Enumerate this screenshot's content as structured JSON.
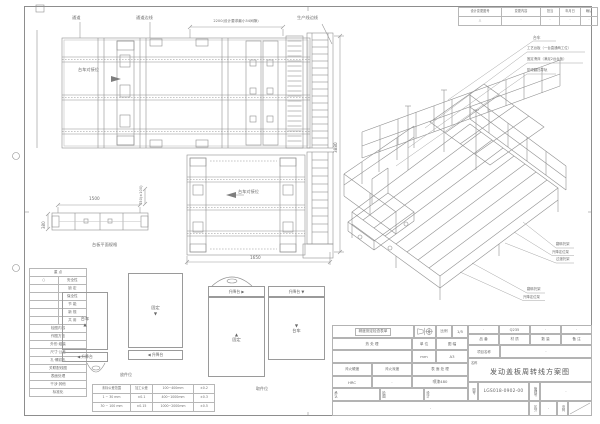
{
  "revision": {
    "headers": [
      "设计变更图号",
      "变更内容",
      "担当",
      "年月日",
      "确认"
    ],
    "values": [
      "△",
      "·",
      "·",
      "·",
      "·"
    ]
  },
  "plan": {
    "passage": "通道",
    "passage_edge": "通道边线",
    "prod_edge": "生产线边线",
    "dim_2200": "2200(设计要求最小54间隙)",
    "dim_3880": "3880",
    "dim_1650": "1650",
    "dock1": "台车对接位",
    "dock2": "台车对接位",
    "arrow_right": "▶",
    "arrow_left": "◀",
    "side": {
      "dim_1500": "1500",
      "dim_380": "380",
      "dim_750": "750(±100)",
      "caption": "台板平面规格"
    }
  },
  "iso": {
    "callouts_top": [
      "台车",
      "工艺台板（一台直通两工位）",
      "固定滑床（满足2台台板）",
      "防倾翻挡导轨"
    ],
    "callouts_right": [
      "翻转托架",
      "升降定位架",
      "过渡托架"
    ],
    "callouts_lower": [
      "翻转托架",
      "升降定位架"
    ]
  },
  "legend": {
    "title": "重 点",
    "items": [
      {
        "mark": "○",
        "label": "安全性"
      },
      {
        "mark": "",
        "label": "锁 定"
      },
      {
        "mark": "",
        "label": "保全性"
      },
      {
        "mark": "",
        "label": "节 能"
      },
      {
        "mark": "",
        "label": "新 规"
      },
      {
        "mark": "",
        "label": "共 用"
      }
    ],
    "subtitle": "检图内容",
    "checks": [
      "作图方法",
      "外形·组装",
      "尺寸·公差",
      "孔·螺纹孔",
      "关联配线图",
      "表面处理",
      "干涉·其他",
      "标准化"
    ]
  },
  "tolerance": {
    "rows": [
      [
        "未标公差范围",
        "加工公差",
        "100~400mm",
        "±0.2"
      ],
      [
        "1 ~ 30 mm",
        "±0.1",
        "400~1000mm",
        "±0.3"
      ],
      [
        "30 ~ 100 mm",
        "±0.15",
        "1000~2000mm",
        "±0.5"
      ]
    ]
  },
  "stations": {
    "g1_box": "台车",
    "g1_arrow": "▲",
    "g1_lift": "◀ 升降台",
    "g2_box": "固定",
    "g2_arrow": "▼",
    "g2_lift": "◀ 升降台",
    "g3_lift_left": "升降台 ▶",
    "g3_arrow_left": "▲",
    "g3_box_left": "固定",
    "g3_lift_right": "升降台 ▼",
    "g3_arrow_right": "▼",
    "g3_box_right": "台车",
    "label_put": "放件位",
    "label_take": "取件位"
  },
  "title_block": {
    "note": "精度测定检查表单",
    "scale_label": "比例",
    "scale_value": "1/5",
    "heat_label": "热 处 理",
    "heat_value": "",
    "unit_label": "单 位",
    "unit_value": "mm",
    "format_label": "图 幅",
    "format_value": "A3",
    "hardness_label": "淬火硬度",
    "hardness_value": "HRC",
    "depth_label": "淬火深度",
    "depth_value": "·",
    "surface_label": "表 面 处 理",
    "surface_value": "喷漆480",
    "approve_label": "承认",
    "check_label": "检图",
    "design_label": "设计",
    "footer_value": "·",
    "values_row": [
      "·",
      "Q235",
      "·",
      "·"
    ],
    "headers_row": [
      "品 番",
      "材 质",
      "数 量",
      "备 注"
    ],
    "project_label": "项目名称",
    "project_value": "·",
    "name_label": "名称",
    "name_value": "发动盖板周转线方案图",
    "dwg_label": "图号",
    "dwg_no": "LGS018-0902-00",
    "mgmt_label": "管理号",
    "mgmt_value": "·",
    "class_label": "区分",
    "class_value": "·",
    "page_label": "页码"
  }
}
